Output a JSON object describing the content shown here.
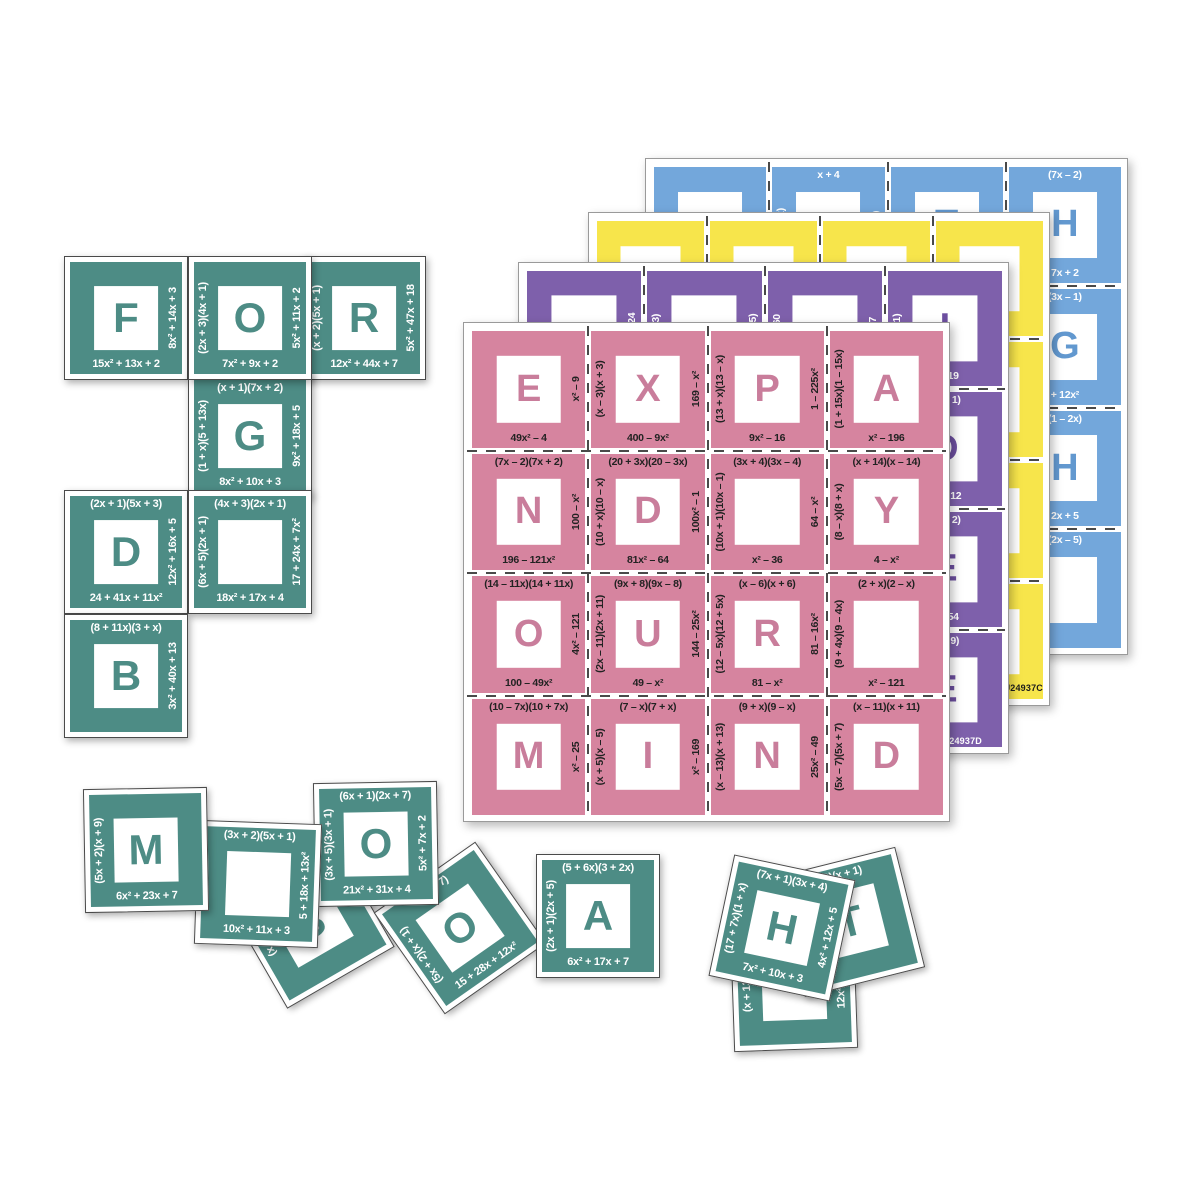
{
  "canvas": {
    "background": "#ffffff"
  },
  "pink_visible_phrase": "EXPAND YOUR MIND",
  "sheets": [
    {
      "id": "blue",
      "x": 645,
      "y": 158,
      "w": 483,
      "h": 497,
      "z": 1,
      "card_color": "#73a7db",
      "letter_color": "#6298cf",
      "text_color": "#ffffff",
      "code": "",
      "cards": [
        {
          "letter": "",
          "top": "",
          "left": "",
          "right": "+ 3x²",
          "bottom": ""
        },
        {
          "letter": "",
          "top": "x + 4",
          "left": "(1 – 3x)",
          "right": "(x – 1)",
          "bottom": ""
        },
        {
          "letter": "T",
          "top": "",
          "left": "",
          "right": "x + 8",
          "bottom": ""
        },
        {
          "letter": "H",
          "top": "(7x – 2)",
          "left": "",
          "right": "",
          "bottom": "7x + 2"
        },
        {},
        {},
        {},
        {
          "letter": "G",
          "top": "(3x – 1)",
          "left": "",
          "right": "",
          "bottom": "+ 12x²"
        },
        {},
        {},
        {},
        {
          "letter": "H",
          "top": "(1 – 2x)",
          "left": "",
          "right": "",
          "bottom": "2x + 5"
        },
        {},
        {},
        {},
        {
          "letter": "",
          "top": "(2x – 5)",
          "left": "",
          "right": "",
          "bottom": ""
        }
      ]
    },
    {
      "id": "yellow",
      "x": 588,
      "y": 212,
      "w": 462,
      "h": 494,
      "z": 2,
      "card_color": "#f7e54b",
      "letter_color": "#1c1c1c",
      "text_color": "#1c1c1c",
      "code": "U24937C",
      "cards": [
        {
          "letter": "",
          "top": "",
          "left": "",
          "right": "– 36",
          "bottom": ""
        },
        {
          "letter": "E",
          "top": "",
          "left": "(x – 3)",
          "right": "",
          "bottom": ""
        },
        {
          "letter": "A",
          "top": "",
          "left": "– 20",
          "right": "(x + 2)",
          "bottom": ""
        },
        {
          "letter": "",
          "top": "",
          "left": "(1 + x)",
          "right": "",
          "bottom": "0x – x²"
        },
        {},
        {},
        {},
        {
          "letter": "E",
          "top": ")(2 – x)",
          "left": "",
          "right": "",
          "bottom": "2x – x²"
        },
        {},
        {},
        {},
        {
          "letter": "H",
          "top": ")(3 – x)",
          "left": "",
          "right": "",
          "bottom": "3x – x²"
        },
        {},
        {},
        {},
        {
          "letter": "S",
          "top": "(5 + x)",
          "left": "",
          "right": "",
          "bottom": ""
        }
      ]
    },
    {
      "id": "purple",
      "x": 518,
      "y": 262,
      "w": 491,
      "h": 492,
      "z": 3,
      "card_color": "#7e60ab",
      "letter_color": "#6d4fa0",
      "text_color": "#ffffff",
      "code": "U24937D",
      "cards": [
        {
          "letter": "",
          "top": "",
          "left": "",
          "right": "x² – 24",
          "bottom": ""
        },
        {
          "letter": "",
          "top": "",
          "left": "(x – 3)",
          "right": "(x + 5)",
          "bottom": ""
        },
        {
          "letter": "",
          "top": "",
          "left": "x + 60",
          "right": "x + 7",
          "bottom": ""
        },
        {
          "letter": "I",
          "top": "",
          "left": "(x + 1)",
          "right": "",
          "bottom": "x + 19"
        },
        {},
        {},
        {},
        {
          "letter": "D",
          "top": ")(x – 1)",
          "left": "",
          "right": "",
          "bottom": "4x – 12"
        },
        {},
        {},
        {},
        {
          "letter": "E",
          "top": ")(x – 2)",
          "left": "",
          "right": "",
          "bottom": "x + 54"
        },
        {},
        {},
        {},
        {
          "letter": "E",
          "top": "(x + 9)",
          "left": "",
          "right": "",
          "bottom": ""
        }
      ]
    },
    {
      "id": "pink",
      "x": 463,
      "y": 322,
      "w": 487,
      "h": 500,
      "z": 4,
      "card_color": "#d6849f",
      "letter_color": "#c97d9b",
      "text_color": "#222222",
      "code": "",
      "cards": [
        {
          "letter": "E",
          "top": "",
          "left": "",
          "right": "x² – 9",
          "bottom": "49x² – 4"
        },
        {
          "letter": "X",
          "top": "",
          "left": "(x – 3)(x + 3)",
          "right": "169 – x²",
          "bottom": "400 – 9x²"
        },
        {
          "letter": "P",
          "top": "",
          "left": "(13 + x)(13 – x)",
          "right": "1 – 225x²",
          "bottom": "9x² – 16"
        },
        {
          "letter": "A",
          "top": "",
          "left": "(1 + 15x)(1 – 15x)",
          "right": "",
          "bottom": "x² – 196"
        },
        {
          "letter": "N",
          "top": "(7x – 2)(7x + 2)",
          "left": "",
          "right": "100 – x²",
          "bottom": "196 – 121x²"
        },
        {
          "letter": "D",
          "top": "(20 + 3x)(20 – 3x)",
          "left": "(10 + x)(10 – x)",
          "right": "100x² – 1",
          "bottom": "81x² – 64"
        },
        {
          "letter": "",
          "top": "(3x + 4)(3x – 4)",
          "left": "(10x + 1)(10x – 1)",
          "right": "64 – x²",
          "bottom": "x² – 36"
        },
        {
          "letter": "Y",
          "top": "(x + 14)(x – 14)",
          "left": "(8 – x)(8 + x)",
          "right": "",
          "bottom": "4 – x²"
        },
        {
          "letter": "O",
          "top": "(14 – 11x)(14 + 11x)",
          "left": "",
          "right": "4x² – 121",
          "bottom": "100 – 49x²"
        },
        {
          "letter": "U",
          "top": "(9x + 8)(9x – 8)",
          "left": "(2x – 11)(2x + 11)",
          "right": "144 – 25x²",
          "bottom": "49 – x²"
        },
        {
          "letter": "R",
          "top": "(x – 6)(x + 6)",
          "left": "(12 – 5x)(12 + 5x)",
          "right": "81 – 16x²",
          "bottom": "81 – x²"
        },
        {
          "letter": "",
          "top": "(2 + x)(2 – x)",
          "left": "(9 + 4x)(9 – 4x)",
          "right": "",
          "bottom": "x² – 121"
        },
        {
          "letter": "M",
          "top": "(10 – 7x)(10 + 7x)",
          "left": "",
          "right": "x² – 25",
          "bottom": ""
        },
        {
          "letter": "I",
          "top": "(7 – x)(7 + x)",
          "left": "(x + 5)(x – 5)",
          "right": "x² – 169",
          "bottom": ""
        },
        {
          "letter": "N",
          "top": "(9 + x)(9 – x)",
          "left": "(x – 13)(x + 13)",
          "right": "25x² – 49",
          "bottom": ""
        },
        {
          "letter": "D",
          "top": "(x – 11)(x + 11)",
          "left": "(5x – 7)(5x + 7)",
          "right": "",
          "bottom": ""
        }
      ]
    }
  ],
  "green": {
    "card_color": "#4d8c85",
    "letter_color": "#4d8c85",
    "text_color": "#ffffff",
    "outer": 124,
    "cards": [
      {
        "id": "F",
        "letter": "F",
        "top": "",
        "left": "",
        "right": "8x² + 14x + 3",
        "bottom": "15x² + 13x + 2",
        "x": 64,
        "y": 256,
        "rot": 0,
        "z": 10
      },
      {
        "id": "O1",
        "letter": "O",
        "top": "",
        "left": "(2x + 3)(4x + 1)",
        "right": "5x² + 11x + 2",
        "bottom": "7x² + 9x + 2",
        "x": 188,
        "y": 256,
        "rot": 0,
        "z": 11
      },
      {
        "id": "R",
        "letter": "R",
        "top": "",
        "left": "(x + 2)(5x + 1)",
        "right": "5x² + 47x + 18",
        "bottom": "12x² + 44x + 7",
        "x": 302,
        "y": 256,
        "rot": 0,
        "z": 10
      },
      {
        "id": "G",
        "letter": "G",
        "top": "(x + 1)(7x + 2)",
        "left": "(1 + x)(5 + 13x)",
        "right": "9x² + 18x + 5",
        "bottom": "8x² + 10x + 3",
        "x": 188,
        "y": 374,
        "rot": 0,
        "z": 10
      },
      {
        "id": "D1",
        "letter": "D",
        "top": "(2x + 1)(5x + 3)",
        "left": "",
        "right": "12x² + 16x + 5",
        "bottom": "24 + 41x + 11x²",
        "x": 64,
        "y": 490,
        "rot": 0,
        "z": 10
      },
      {
        "id": "blank1",
        "letter": "",
        "top": "(4x + 3)(2x + 1)",
        "left": "(6x + 5)(2x + 1)",
        "right": "17 + 24x + 7x²",
        "bottom": "18x² + 17x + 4",
        "x": 188,
        "y": 490,
        "rot": 0,
        "z": 10
      },
      {
        "id": "B",
        "letter": "B",
        "top": "(8 + 11x)(3 + x)",
        "left": "",
        "right": "3x² + 40x + 13",
        "bottom": "",
        "x": 64,
        "y": 614,
        "rot": 0,
        "z": 10
      },
      {
        "id": "M",
        "letter": "M",
        "top": "",
        "left": "(5x + 2)(x + 9)",
        "right": "",
        "bottom": "6x² + 23x + 7",
        "x": 84,
        "y": 788,
        "rot": -1,
        "z": 16
      },
      {
        "id": "blank2",
        "letter": "",
        "top": "(3x + 2)(5x + 1)",
        "left": "",
        "right": "5 + 18x + 13x²",
        "bottom": "10x² + 11x + 3",
        "x": 196,
        "y": 822,
        "rot": 2,
        "z": 15
      },
      {
        "id": "S",
        "letter": "S",
        "top": "(x + 1)(3",
        "left": "(x +",
        "right": "",
        "bottom": "",
        "x": 248,
        "y": 862,
        "rot": -30,
        "z": 12
      },
      {
        "id": "O2",
        "letter": "O",
        "top": "(6x + 1)(2x + 7)",
        "left": "(3x + 5)(3x + 1)",
        "right": "5x² + 7x + 2",
        "bottom": "21x² + 31x + 4",
        "x": 314,
        "y": 782,
        "rot": -1,
        "z": 14
      },
      {
        "id": "O3",
        "letter": "O",
        "top": "(2x + 7)",
        "left": "(5x + 2)(x + 1)",
        "right": "",
        "bottom": "15 + 28x + 12x²",
        "x": 398,
        "y": 866,
        "rot": -35,
        "z": 13
      },
      {
        "id": "A",
        "letter": "A",
        "top": "(5 + 6x)(3 + 2x)",
        "left": "(2x + 1)(2x + 5)",
        "right": "",
        "bottom": "6x² + 17x + 7",
        "x": 536,
        "y": 854,
        "rot": 0,
        "z": 14
      },
      {
        "id": "hidden",
        "letter": "",
        "top": "",
        "left": "(x + 13)(3",
        "right": "12x² + 37",
        "bottom": "",
        "x": 732,
        "y": 926,
        "rot": -2,
        "z": 11
      },
      {
        "id": "T",
        "letter": "T",
        "top": "+ 3)(x + 1)",
        "left": "",
        "right": "",
        "bottom": "",
        "x": 788,
        "y": 860,
        "rot": -14,
        "z": 12
      },
      {
        "id": "H",
        "letter": "H",
        "top": "(7x + 1)(3x + 4)",
        "left": "(17 + 7x)(1 + x)",
        "right": "4x² + 12x + 5",
        "bottom": "7x² + 10x + 3",
        "x": 720,
        "y": 866,
        "rot": 12,
        "z": 13
      }
    ]
  }
}
